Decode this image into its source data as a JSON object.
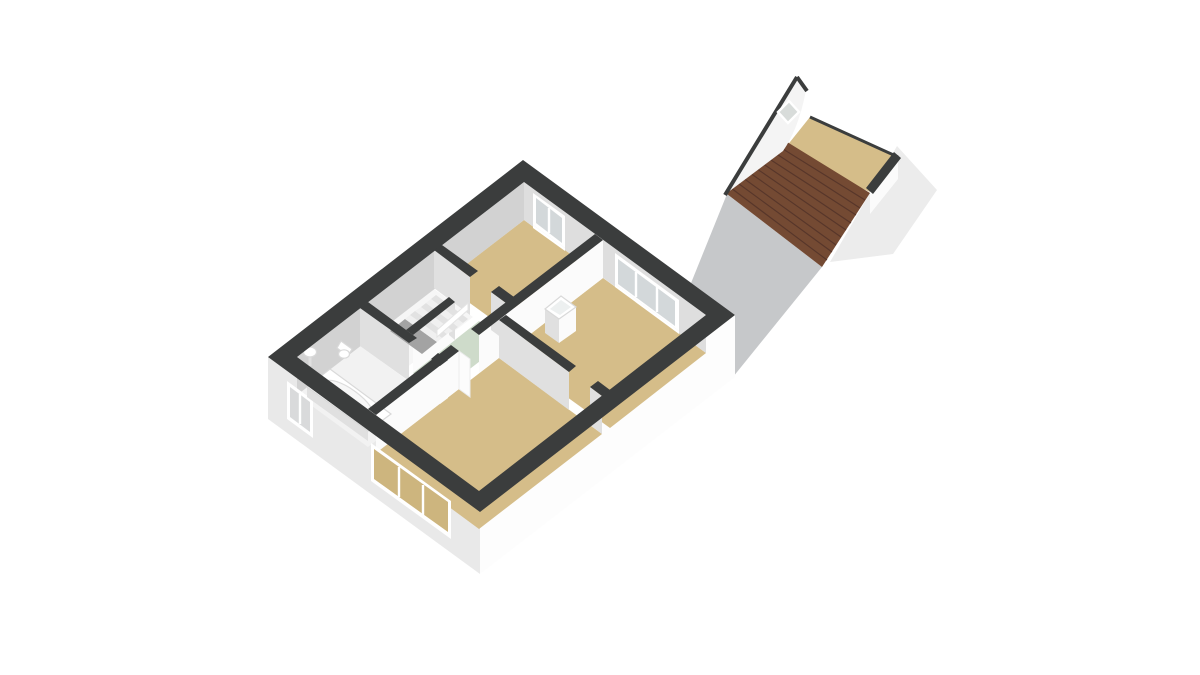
{
  "meta": {
    "width": 1200,
    "height": 675,
    "background": "#ffffff",
    "view": "3d-axonometric-floorplan-render"
  },
  "scene": {
    "colors": {
      "wall_top": "#3b3d3d",
      "floor_wood": "#d5bd89",
      "floor_wood_through_glass": "#cdb57e",
      "floor_bath": "#f2f2f2",
      "floor_stair": "#f6f6f6",
      "floor_hall_mint": "#cedbca",
      "glass": "#d3d8da",
      "glass_bath": "#d9dadb",
      "roof_tile": "#744a33",
      "roof_tile_line": "#57362a",
      "gable_wall": "#f4f4f4",
      "diamond_window": "#d8dcda",
      "driveway": "#c6c8ca",
      "soft_shadow": "#ececec",
      "fixture": "#ffffff",
      "basin_inner": "#edf0f0"
    },
    "main_building": {
      "rooms": [
        {
          "name": "bathroom",
          "floor": "white",
          "fixtures": [
            "bathtub",
            "sink",
            "toilet"
          ]
        },
        {
          "name": "stairwell",
          "floor": "white",
          "fixtures": [
            "staircase",
            "handrail"
          ]
        },
        {
          "name": "hallway-landing",
          "floor": "mint-green",
          "fixtures": []
        },
        {
          "name": "bedroom-small",
          "floor": "wood",
          "fixtures": []
        },
        {
          "name": "bedroom-left",
          "floor": "wood",
          "fixtures": [
            "door-leaf"
          ]
        },
        {
          "name": "bedroom-right",
          "floor": "wood",
          "fixtures": [
            "washbasin"
          ]
        }
      ],
      "windows": [
        {
          "name": "sw-facade-bathroom-window",
          "panes": 2
        },
        {
          "name": "sw-facade-bedroom-left-window",
          "panes": 3
        },
        {
          "name": "ne-facade-bedroom-small-window",
          "panes": 2
        },
        {
          "name": "ne-facade-bedroom-right-window",
          "panes": 3
        }
      ],
      "doors": [
        {
          "name": "bathroom-door-opening"
        },
        {
          "name": "bedroom-small-door-opening"
        },
        {
          "name": "bedroom-left-door-opening"
        },
        {
          "name": "bedroom-right-door-opening"
        },
        {
          "name": "stairwell-opening"
        }
      ]
    },
    "outbuilding": {
      "name": "shed-attic",
      "roof": "pitched-brown-tiles",
      "floor": "wood",
      "gable_window": "diamond"
    },
    "ground": {
      "driveway": "gray-path",
      "shadow": "soft-gray"
    }
  }
}
